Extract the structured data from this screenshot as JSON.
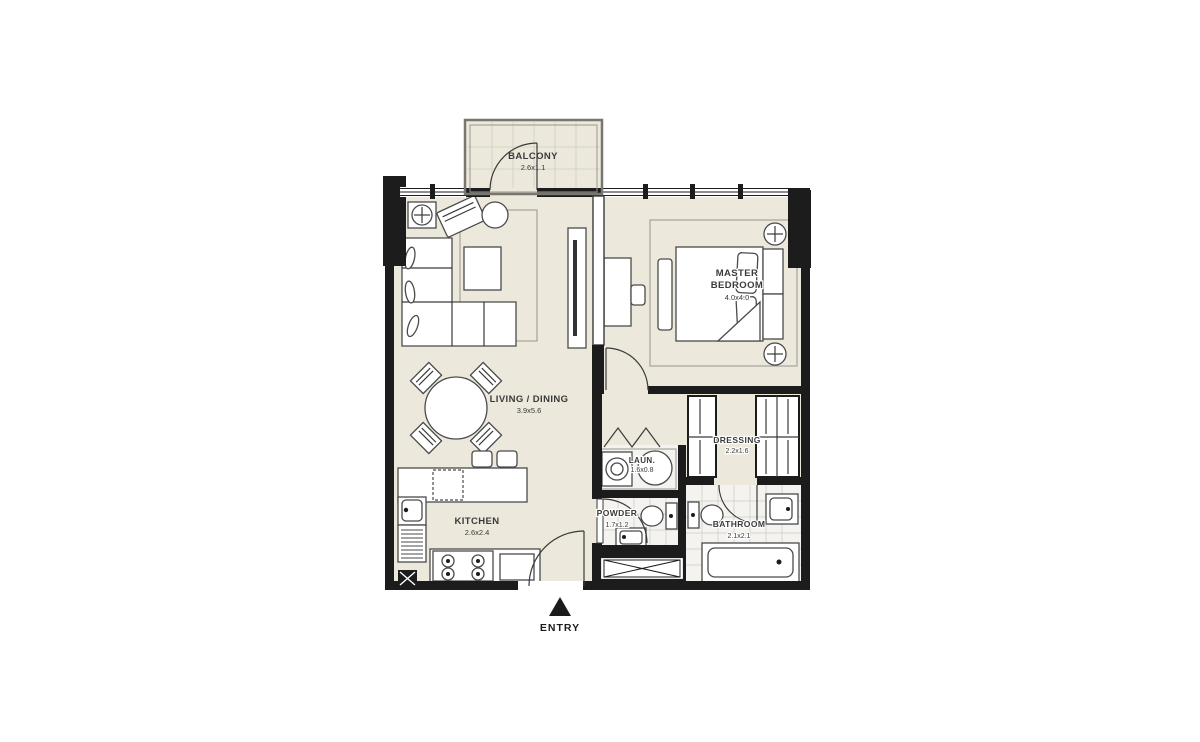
{
  "plan": {
    "title": "1 Bedroom Apartment Floor Plan",
    "entry": {
      "label": "ENTRY"
    },
    "rooms": {
      "balcony": {
        "name": "BALCONY",
        "dims": "2.6x1.1"
      },
      "living_dining": {
        "name": "LIVING / DINING",
        "dims": "3.9x5.6"
      },
      "master_bedroom": {
        "name_line1": "MASTER",
        "name_line2": "BEDROOM",
        "dims": "4.0x4.0"
      },
      "kitchen": {
        "name": "KITCHEN",
        "dims": "2.6x2.4"
      },
      "laundry": {
        "name": "LAUN.",
        "dims": "1.6x0.8"
      },
      "powder": {
        "name": "POWDER",
        "dims": "1.7x1.2"
      },
      "dressing": {
        "name": "DRESSING",
        "dims": "2.2x1.6"
      },
      "bathroom": {
        "name": "BATHROOM",
        "dims": "2.1x2.1"
      }
    },
    "colors": {
      "wall": "#1c1c1c",
      "floor": "#ece8dc",
      "tile_line": "#cfccc2",
      "furniture_line": "#4a4a4a",
      "text": "#3a3a3a"
    }
  }
}
